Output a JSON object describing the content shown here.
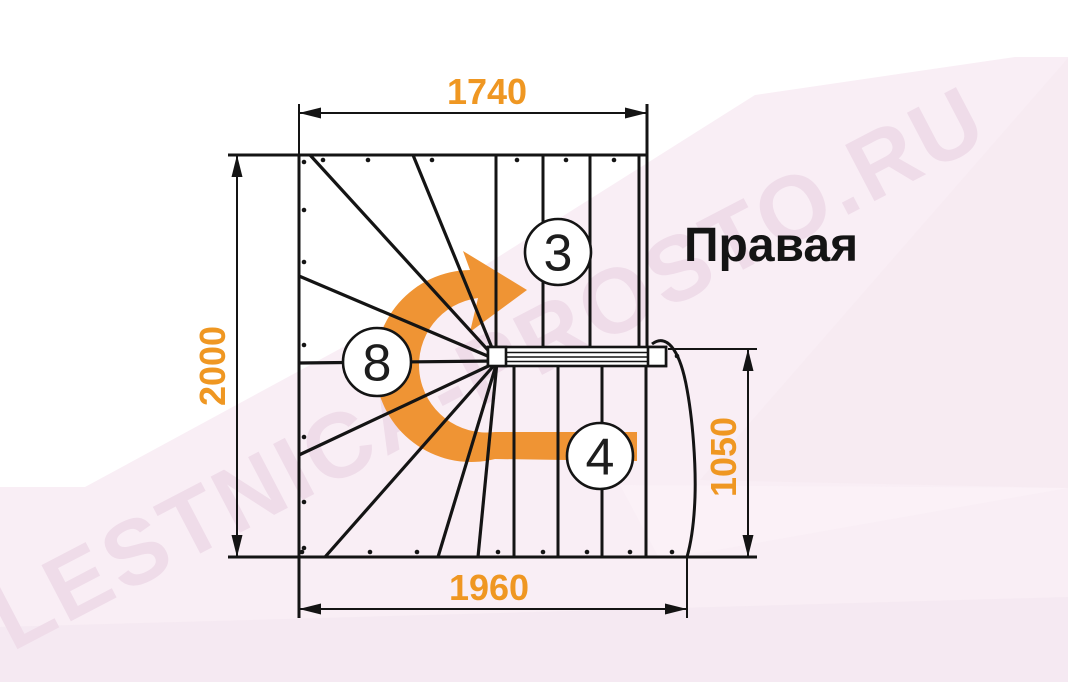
{
  "diagram": {
    "title_label": "Правая",
    "watermark": "LESTNICA-PROSTO.RU",
    "dims": {
      "top": "1740",
      "left": "2000",
      "bottom": "1960",
      "right": "1050"
    },
    "steps": {
      "upper_flight": "3",
      "winder": "8",
      "lower_flight": "4"
    },
    "colors": {
      "dimension_text": "#EF9722",
      "direction_arrow": "#EF9434",
      "linework": "#141414",
      "background_tint": "#f9eef5",
      "watermark": "#efdce9"
    }
  }
}
